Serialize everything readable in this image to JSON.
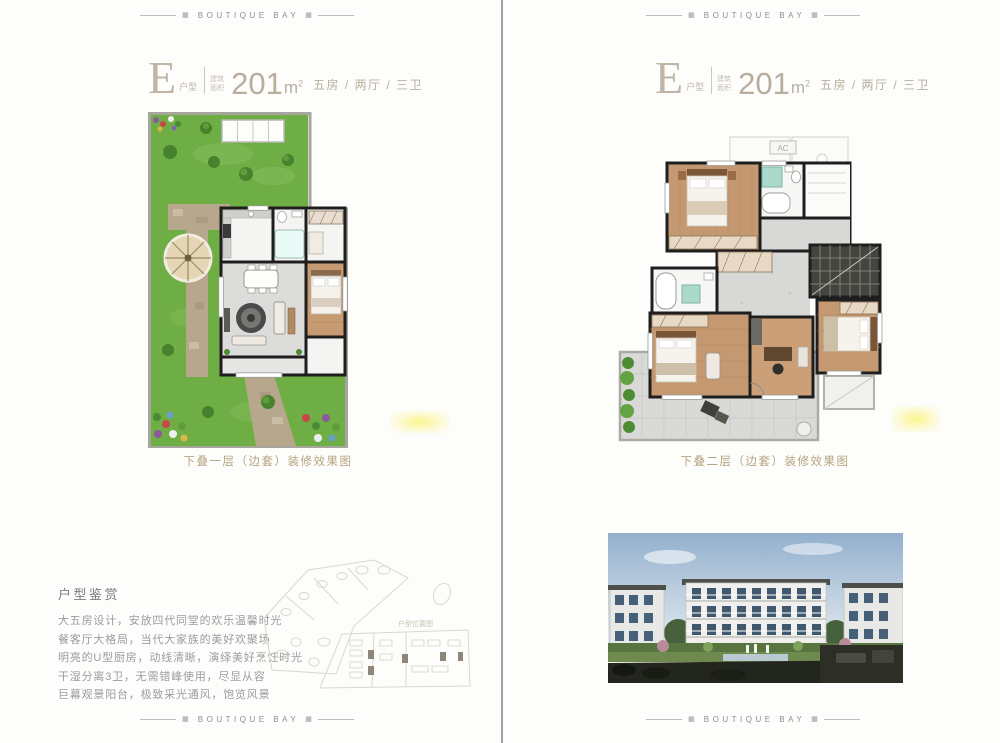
{
  "brand": {
    "name": "BOUTIQUE BAY",
    "ornament": "▦"
  },
  "pages": {
    "left": {
      "title": {
        "letter": "E",
        "letter_suffix": "户型",
        "note_line1": "建筑",
        "note_line2": "面积",
        "area": "201",
        "unit_base": "m",
        "unit_sup": "2",
        "spec": "五房 / 两厅 / 三卫"
      },
      "caption": "下叠一层（边套）装修效果图"
    },
    "right": {
      "title": {
        "letter": "E",
        "letter_suffix": "户型",
        "note_line1": "建筑",
        "note_line2": "面积",
        "area": "201",
        "unit_base": "m",
        "unit_sup": "2",
        "spec": "五房 / 两厅 / 三卫"
      },
      "caption": "下叠二层（边套）装修效果图",
      "ac_label": "AC"
    }
  },
  "appreciation": {
    "heading": "户型鉴赏",
    "lines": [
      "大五房设计，安放四代同堂的欢乐温馨时光",
      "餐客厅大格局，当代大家族的美好欢聚场",
      "明亮的U型厨房，动线清晰，演绎美好烹饪时光",
      "干湿分离3卫，无需错峰使用，尽显从容",
      "巨幕观景阳台，极致采光通风，饱览风景"
    ]
  },
  "keyplan": {
    "label": "户型位置图"
  },
  "colors": {
    "accent_tan": "#b5a47f",
    "title_text": "#b9ae9e",
    "wall_dark": "#1e1e1e",
    "garden_green": "#6fae45",
    "wood_floor": "#c49972",
    "tile_gray": "#d8d8d6",
    "teal_fixture": "#abdacd"
  }
}
